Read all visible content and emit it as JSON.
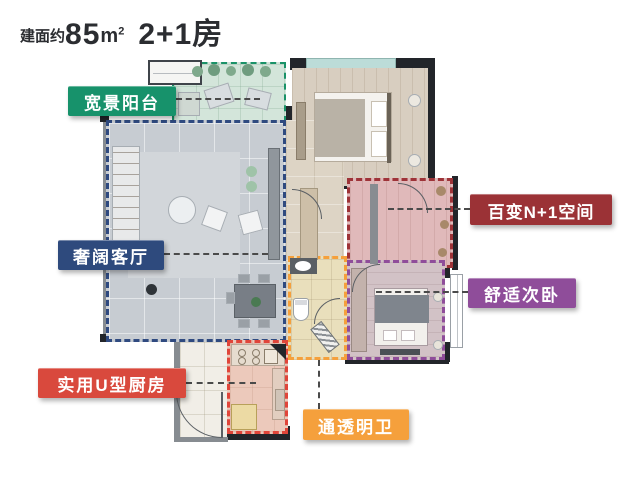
{
  "title": {
    "prefix": "建面约",
    "area": "85",
    "unit_base": "m",
    "unit_sup": "2",
    "suffix": "2+1房"
  },
  "labels": {
    "balcony": {
      "text": "宽景阳台",
      "color": "#17926b"
    },
    "living_room": {
      "text": "奢阔客厅",
      "color": "#2e4a7d"
    },
    "kitchen": {
      "text": "实用U型厨房",
      "color": "#d9493d"
    },
    "bathroom": {
      "text": "通透明卫",
      "color": "#f5a03c"
    },
    "n_plus_1": {
      "text": "百变N+1空间",
      "color": "#9b3236"
    },
    "secondary_bedroom": {
      "text": "舒适次卧",
      "color": "#8f4d9a"
    }
  },
  "outlines": {
    "balcony": "#1a9268",
    "living_room": "#2f4a80",
    "kitchen": "#e0453a",
    "bathroom": "#f5a03c",
    "n_plus_1": "#9e3338",
    "secondary_bedroom": "#8f4d9a"
  }
}
